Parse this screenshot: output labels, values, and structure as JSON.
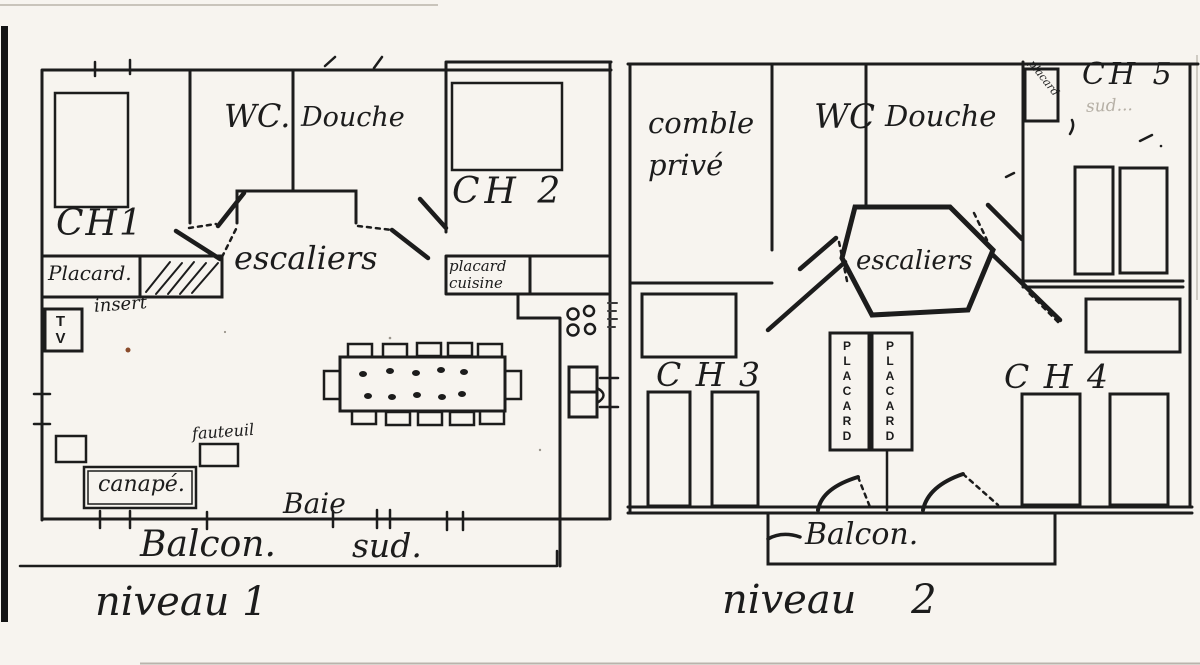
{
  "colors": {
    "ink": "#1c1c1c",
    "paper": "#f7f4ef",
    "faint_pencil": "#b6b0a6",
    "accent_dot": "#8a4b2b",
    "scan_edge": "#141414"
  },
  "level1": {
    "caption": "niveau 1",
    "labels": {
      "ch1": "CH1",
      "wc": "WC.",
      "douche": "Douche",
      "ch2": "CH 2",
      "escaliers": "escaliers",
      "placard": "Placard.",
      "insert": "insert",
      "placard_cuisine_line1": "placard",
      "placard_cuisine_line2": "cuisine",
      "tv": "TV",
      "fauteuil": "fauteuil",
      "canape": "canapé.",
      "baie": "Baie",
      "balcon": "Balcon.",
      "sud": "sud."
    }
  },
  "level2": {
    "caption": "niveau 2",
    "labels": {
      "comble_line1": "comble",
      "comble_line2": "privé",
      "wc": "WC",
      "douche": "Douche",
      "ch5": "CH 5",
      "ch5_sub_faint": "sud...",
      "placard_small": "placard",
      "escaliers": "escaliers",
      "ch3": "C H 3",
      "ch4": "C H 4",
      "placard_left": "PLACARD",
      "placard_right": "PLACARD",
      "balcon": "Balcon."
    }
  }
}
